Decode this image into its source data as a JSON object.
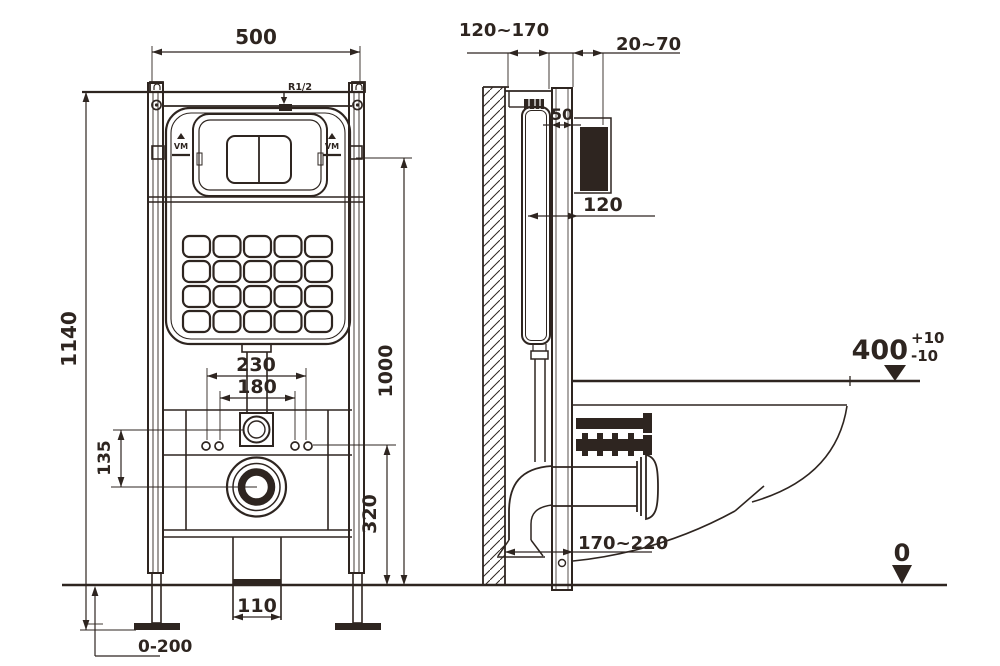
{
  "colors": {
    "line": "#2e2520",
    "background": "#ffffff"
  },
  "front_view": {
    "dimensions": {
      "frame_width": "500",
      "frame_height": "1140",
      "flush_plate_height": "1000",
      "bolt_spacing_outer": "230",
      "bolt_spacing_inner": "180",
      "inlet_to_outlet": "135",
      "outlet_height": "320",
      "drain_pipe_width": "110",
      "foot_adjustment": "0-200"
    },
    "labels": {
      "water_inlet": "R1/2",
      "logo_left": "VM",
      "logo_right": "VM"
    }
  },
  "side_view": {
    "dimensions": {
      "wall_to_frame": "120~170",
      "plate_box_depth": "20~70",
      "frame_profile_depth": "50",
      "tank_depth": "120",
      "outlet_distance": "170~220",
      "rim_height": "400",
      "rim_tolerance_plus": "+10",
      "rim_tolerance_minus": "-10",
      "floor_level": "0"
    }
  }
}
